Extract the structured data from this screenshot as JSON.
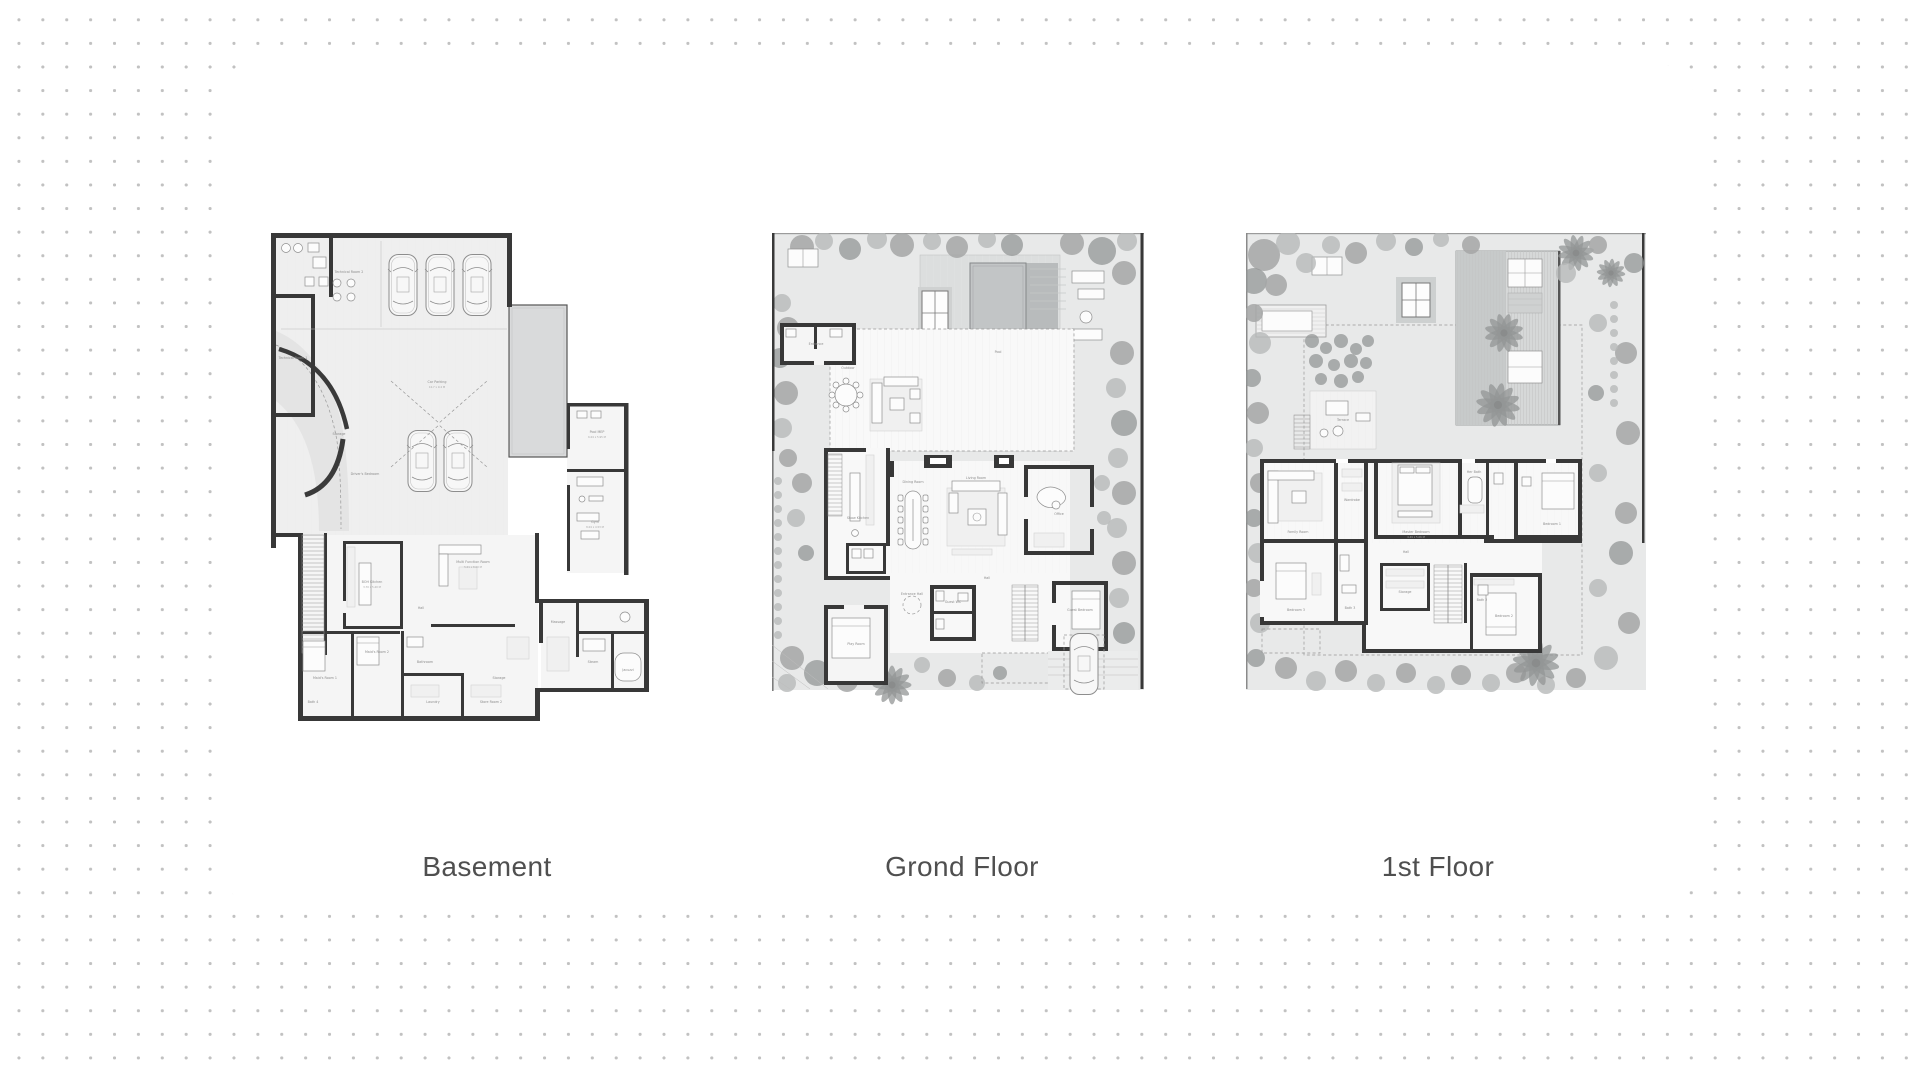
{
  "colors": {
    "dot": "#c1c1c1",
    "panel": "#ffffff",
    "wall": "#383838",
    "caption_text": "#4f4f4f",
    "pool": "#c3c6c7",
    "garden": "#e8e9e9",
    "tree": "#a4a6a6"
  },
  "plans": [
    {
      "id": "basement",
      "label": "Basement",
      "rooms": [
        {
          "label": "Technical Room 2"
        },
        {
          "label": "Technical Room 1"
        },
        {
          "label": "Car Parking",
          "dim": "10.7 x 9.4 M"
        },
        {
          "label": "Storage"
        },
        {
          "label": "Driver's Bedroom"
        },
        {
          "label": "Pool MEP",
          "dim": "6.04 x 5.95 M"
        },
        {
          "label": "Gym",
          "dim": "8.04 x 4.53 M"
        },
        {
          "label": "Massage"
        },
        {
          "label": "Steam"
        },
        {
          "label": "Jacuzzi"
        },
        {
          "label": "BOH Kitchen",
          "dim": "3.70 x 5.40 M"
        },
        {
          "label": "Multi Function Room",
          "dim": "5.01 x 8.00 M"
        },
        {
          "label": "Hall"
        },
        {
          "label": "Maid's Room 2"
        },
        {
          "label": "Maid's Room 1"
        },
        {
          "label": "Bathroom"
        },
        {
          "label": "Laundry"
        },
        {
          "label": "Storage"
        },
        {
          "label": "Store Room 2"
        },
        {
          "label": "Bath 4"
        }
      ]
    },
    {
      "id": "grond-floor",
      "label": "Grond Floor",
      "rooms": [
        {
          "label": "Entrance"
        },
        {
          "label": "Outdoor"
        },
        {
          "label": "Pool"
        },
        {
          "label": "Show Kitchen"
        },
        {
          "label": "Dining Room"
        },
        {
          "label": "Living Room"
        },
        {
          "label": "Office"
        },
        {
          "label": "Hall"
        },
        {
          "label": "Entrance Hall"
        },
        {
          "label": "Guest Bedroom"
        },
        {
          "label": "Guest WC"
        },
        {
          "label": "Play Room"
        }
      ]
    },
    {
      "id": "first-floor",
      "label": "1st Floor",
      "rooms": [
        {
          "label": "Terrace"
        },
        {
          "label": "Family Room"
        },
        {
          "label": "Master Bedroom",
          "dim": "4.49 x 5.06 M"
        },
        {
          "label": "Her Bath"
        },
        {
          "label": "Wardrobe"
        },
        {
          "label": "Bedroom 1"
        },
        {
          "label": "Hall"
        },
        {
          "label": "Bedroom 3"
        },
        {
          "label": "Bath 3"
        },
        {
          "label": "Storage"
        },
        {
          "label": "Bedroom 2"
        },
        {
          "label": "Bath 2"
        }
      ]
    }
  ]
}
